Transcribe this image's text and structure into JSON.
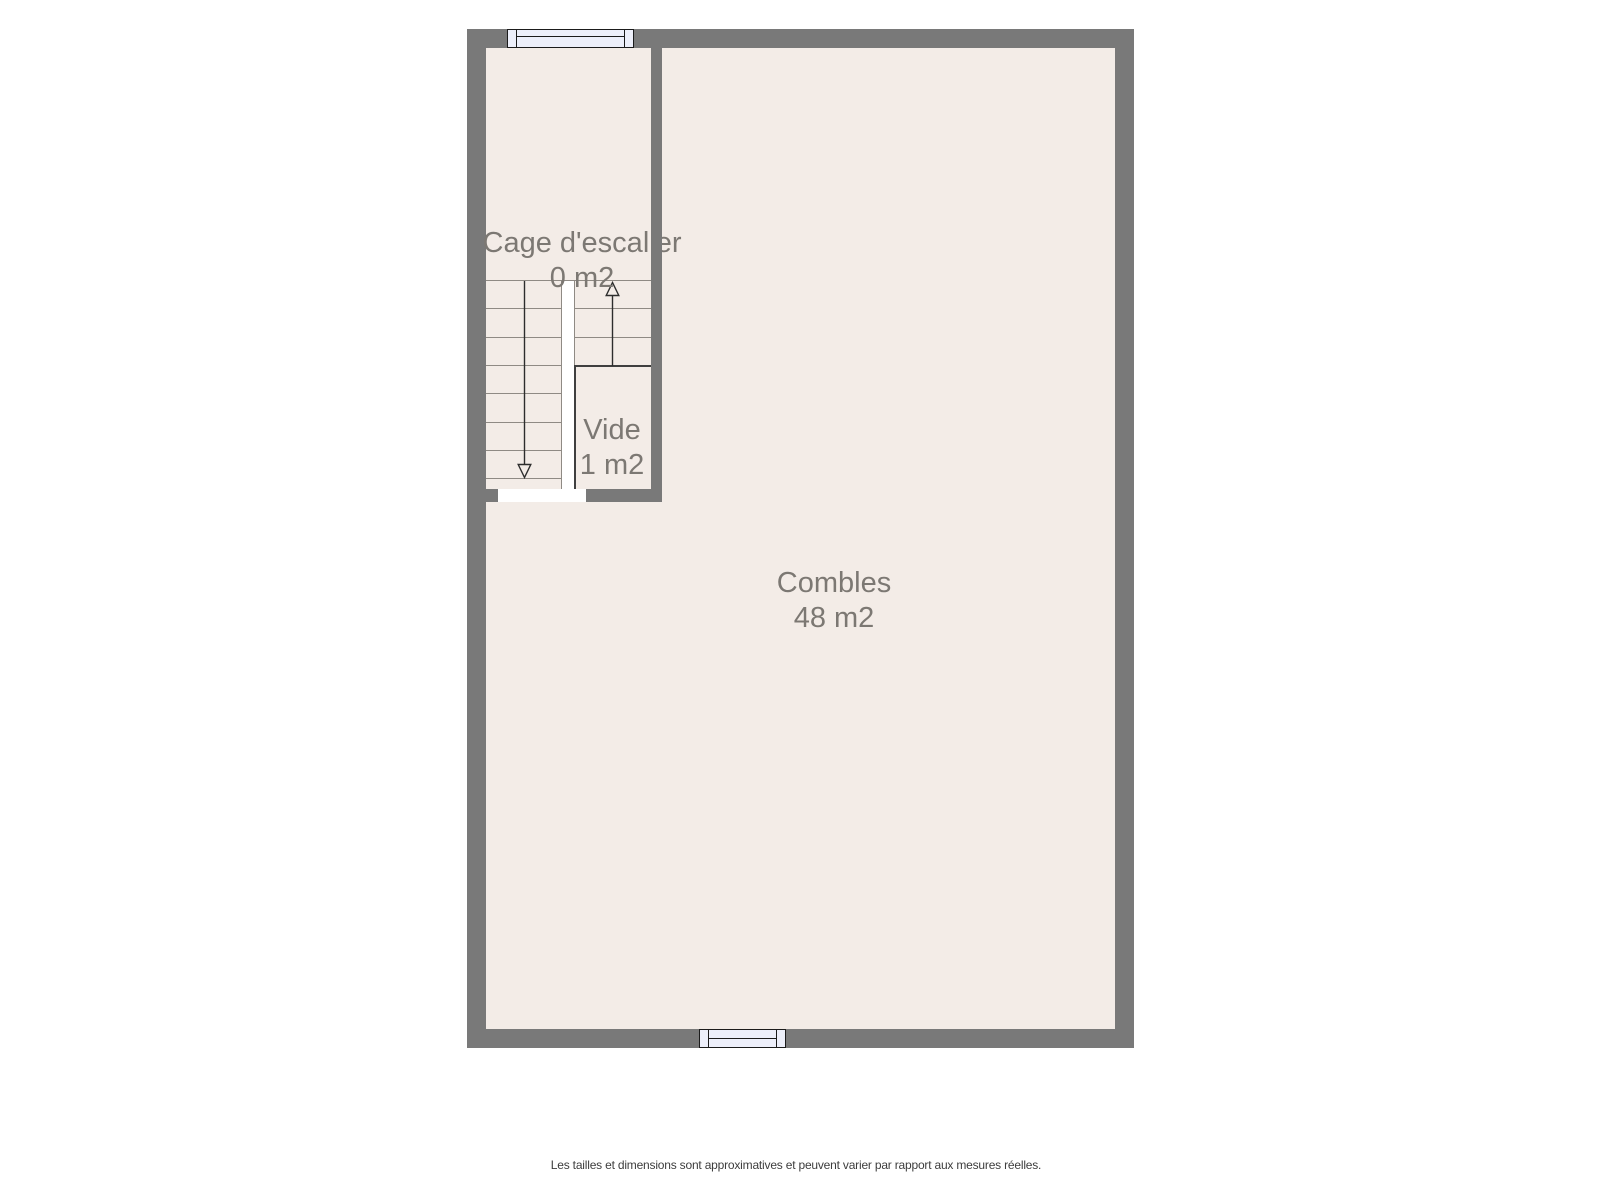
{
  "page": {
    "background": "#ffffff"
  },
  "floor_plan": {
    "rooms": [
      {
        "id": "cage-escalier",
        "name": "Cage d'escalier",
        "area": "0 m2"
      },
      {
        "id": "vide",
        "name": "Vide",
        "area": "1 m2"
      },
      {
        "id": "combles",
        "name": "Combles",
        "area": "48 m2"
      }
    ],
    "icons": {
      "window_top": "window-icon",
      "window_bottom": "window-icon",
      "stairs_up": "stairs-up-arrow-icon",
      "stairs_down": "stairs-down-arrow-icon"
    },
    "colors": {
      "wall": "#797979",
      "floor": "#f3ece7",
      "window_fill": "#edeffa",
      "window_border": "#1b1b1b",
      "stair_line": "#8f8a84",
      "void_border": "#3f3f3f",
      "arrow": "#2d2d2d",
      "label_text": "#7c7873",
      "opening": "#ffffff"
    }
  },
  "footer": {
    "disclaimer": "Les tailles et dimensions sont approximatives et peuvent varier par rapport aux mesures réelles."
  }
}
